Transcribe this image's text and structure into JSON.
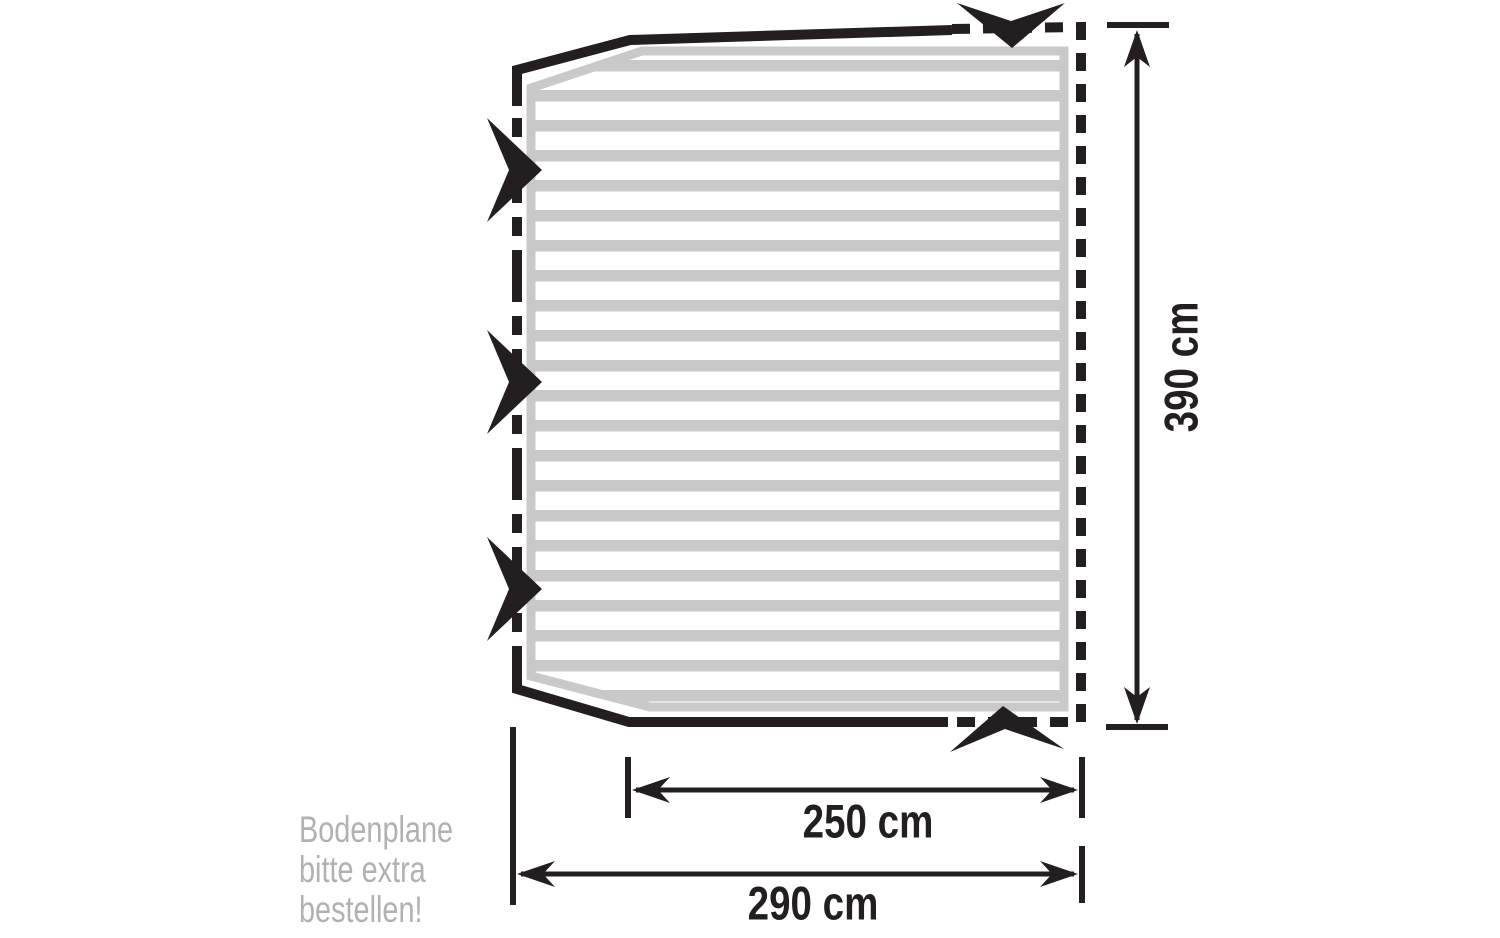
{
  "colors": {
    "ink": "#231f20",
    "stripe": "#c9c9c9",
    "note": "#b1b1b1"
  },
  "dimensions": {
    "height": "390 cm",
    "inner_width": "250 cm",
    "outer_width": "290 cm"
  },
  "note": {
    "line1": "Bodenplane",
    "line2": "bitte extra",
    "line3": "bestellen!"
  }
}
